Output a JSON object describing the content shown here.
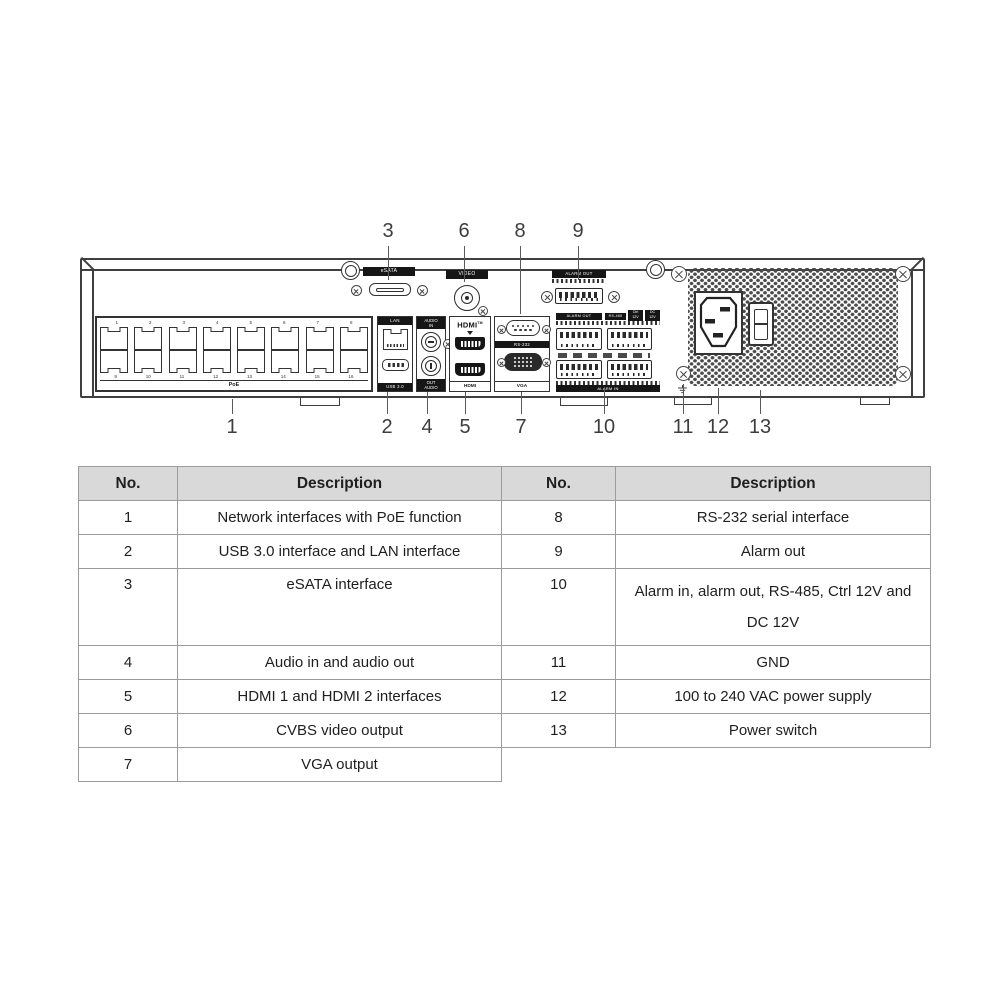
{
  "colors": {
    "line": "#3f3f3f",
    "bar_bg": "#161616",
    "bar_text": "#ffffff",
    "table_border": "#9b9b9b",
    "table_header_bg": "#d9d9d9",
    "text": "#1f1f1f"
  },
  "diagram": {
    "labels": {
      "esata": "eSATA",
      "video": "VIDEO",
      "lan": "LAN",
      "usb": "USB 3.0",
      "audio_top_line1": "AUDIO",
      "audio_top_line2": "IN",
      "audio_bottom_line1": "OUT",
      "audio_bottom_line2": "AUDIO",
      "hdmi_logo": "HDMI",
      "hdmi_tm": "TM",
      "hdmi_bottom": "HDMI",
      "rs232": "RS-232",
      "vga": "VGA",
      "alarm_out_top": "ALARM OUT",
      "alarm_out": "ALARM OUT",
      "rs485": "RS-485",
      "ctrl_line1": "Ctrl",
      "ctrl_line2": "12V",
      "dc_line1": "DC",
      "dc_line2": "12V",
      "alarm_in": "ALARM IN"
    },
    "poe": {
      "label": "PoE",
      "numbers_top": [
        "1",
        "2",
        "3",
        "4",
        "5",
        "6",
        "7",
        "8"
      ],
      "numbers_bottom": [
        "9",
        "10",
        "11",
        "12",
        "13",
        "14",
        "15",
        "16"
      ],
      "ports_per_row": 8
    },
    "callouts_top": [
      {
        "n": "3",
        "x": 388,
        "y1": 246,
        "y2": 280
      },
      {
        "n": "6",
        "x": 464,
        "y1": 246,
        "y2": 282
      },
      {
        "n": "8",
        "x": 520,
        "y1": 246,
        "y2": 314
      },
      {
        "n": "9",
        "x": 578,
        "y1": 246,
        "y2": 280
      }
    ],
    "callouts_bottom": [
      {
        "n": "1",
        "x": 232,
        "y1": 399,
        "y2": 414
      },
      {
        "n": "2",
        "x": 387,
        "y1": 392,
        "y2": 414
      },
      {
        "n": "4",
        "x": 427,
        "y1": 392,
        "y2": 414
      },
      {
        "n": "5",
        "x": 465,
        "y1": 392,
        "y2": 414
      },
      {
        "n": "7",
        "x": 521,
        "y1": 392,
        "y2": 414
      },
      {
        "n": "10",
        "x": 604,
        "y1": 389,
        "y2": 414
      },
      {
        "n": "11",
        "x": 683,
        "y1": 384,
        "y2": 414
      },
      {
        "n": "12",
        "x": 718,
        "y1": 388,
        "y2": 414
      },
      {
        "n": "13",
        "x": 760,
        "y1": 390,
        "y2": 414
      }
    ]
  },
  "table": {
    "headers": [
      "No.",
      "Description",
      "No.",
      "Description"
    ],
    "rows": [
      {
        "l_no": "1",
        "l_desc": "Network interfaces with PoE function",
        "r_no": "8",
        "r_desc": "RS-232 serial interface",
        "tall": false
      },
      {
        "l_no": "2",
        "l_desc": "USB 3.0 interface and LAN interface",
        "r_no": "9",
        "r_desc": "Alarm out",
        "tall": false
      },
      {
        "l_no": "3",
        "l_desc": "eSATA interface",
        "r_no": "10",
        "r_desc": "Alarm in, alarm out, RS-485, Ctrl 12V and DC 12V",
        "tall": true
      },
      {
        "l_no": "4",
        "l_desc": "Audio in and audio out",
        "r_no": "11",
        "r_desc": "GND",
        "tall": false
      },
      {
        "l_no": "5",
        "l_desc": "HDMI 1 and HDMI 2 interfaces",
        "r_no": "12",
        "r_desc": "100 to 240 VAC power supply",
        "tall": false
      },
      {
        "l_no": "6",
        "l_desc": "CVBS video output",
        "r_no": "13",
        "r_desc": "Power switch",
        "tall": false
      },
      {
        "l_no": "7",
        "l_desc": "VGA output",
        "r_no": null,
        "r_desc": null,
        "tall": false
      }
    ]
  }
}
